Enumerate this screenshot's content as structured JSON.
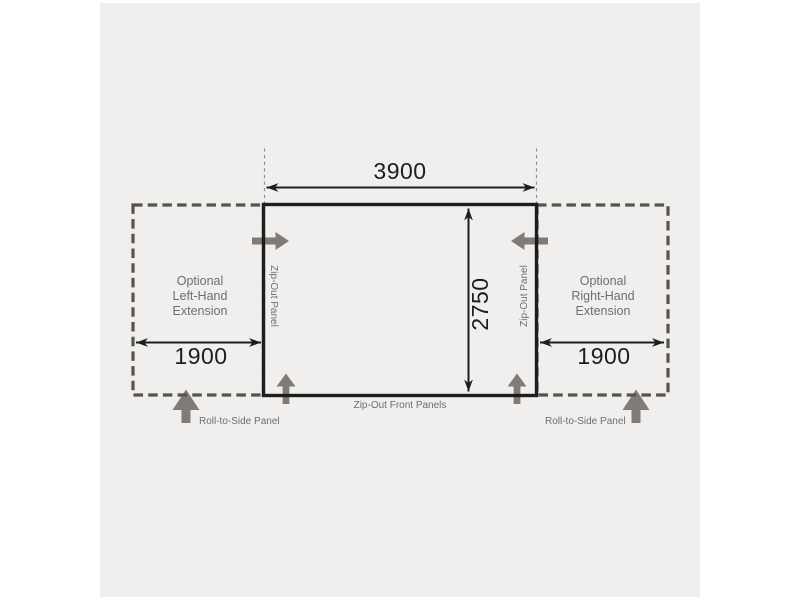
{
  "colors": {
    "background": "#ffffff",
    "panel": "#f0efee",
    "ink": "#1d1d1b",
    "dash": "#57534f",
    "arrow": "#817b77",
    "gray_text": "#6d6e71",
    "guide": "#8f8f8f"
  },
  "diagram": {
    "main_width_label": "3900",
    "main_depth_label": "2750",
    "left_extension": {
      "lines": [
        "Optional",
        "Left-Hand",
        "Extension"
      ],
      "width_label": "1900"
    },
    "right_extension": {
      "lines": [
        "Optional",
        "Right-Hand",
        "Extension"
      ],
      "width_label": "1900"
    },
    "left_zip_panel_label": "Zip-Out Panel",
    "right_zip_panel_label": "Zip-Out Panel",
    "front_panels_label": "Zip-Out Front Panels",
    "left_roll_label": "Roll-to-Side Panel",
    "right_roll_label": "Roll-to-Side Panel"
  },
  "icons": {
    "gray_arrows": [
      "left-zip-out-arrow",
      "right-zip-out-arrow",
      "front-left-zip-out-arrow",
      "front-right-zip-out-arrow",
      "left-roll-to-side-arrow",
      "right-roll-to-side-arrow"
    ]
  }
}
